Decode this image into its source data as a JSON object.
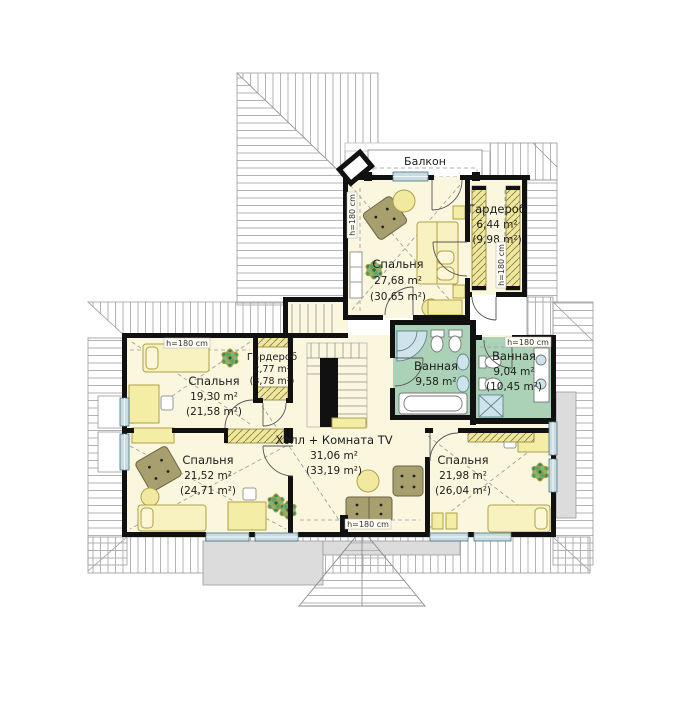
{
  "balcony_label": "Балкон",
  "height_note": "h=180 cm",
  "rooms": [
    {
      "key": "bedroom-top",
      "name": "Спальня",
      "area": "27,68 m²",
      "area_total": "(30,65 m²)"
    },
    {
      "key": "wardrobe-top",
      "name": "Гардероб",
      "area": "6,44 m²",
      "area_total": "(9,98 m²)"
    },
    {
      "key": "bedroom-left",
      "name": "Спальня",
      "area": "19,30 m²",
      "area_total": "(21,58 m²)"
    },
    {
      "key": "wardrobe-small",
      "name": "Гардероб",
      "area": "2,77 m²",
      "area_total": "(3,78 m²)"
    },
    {
      "key": "bathroom-left",
      "name": "Ванная",
      "area": "9,58 m²",
      "area_total": ""
    },
    {
      "key": "bathroom-right",
      "name": "Ванная",
      "area": "9,04 m²",
      "area_total": "(10,45 m²)"
    },
    {
      "key": "bedroom-bottom-left",
      "name": "Спальня",
      "area": "21,52 m²",
      "area_total": "(24,71 m²)"
    },
    {
      "key": "hall-tv",
      "name": "Холл + Комната TV",
      "area": "31,06 m²",
      "area_total": "(33,19 m²)"
    },
    {
      "key": "bedroom-bottom-right",
      "name": "Спальня",
      "area": "21,98 m²",
      "area_total": "(26,04 m²)"
    }
  ],
  "colors": {
    "room_fill": "#faf7de",
    "bath_fill": "#abd2b6",
    "wall": "#111111",
    "furniture_yellow": "#f4eda6",
    "furniture_olive": "#a89f6e",
    "window_blue": "#c8dce2",
    "roof_hatch": "#b3b3b3",
    "plant_green": "#3e9e63"
  }
}
